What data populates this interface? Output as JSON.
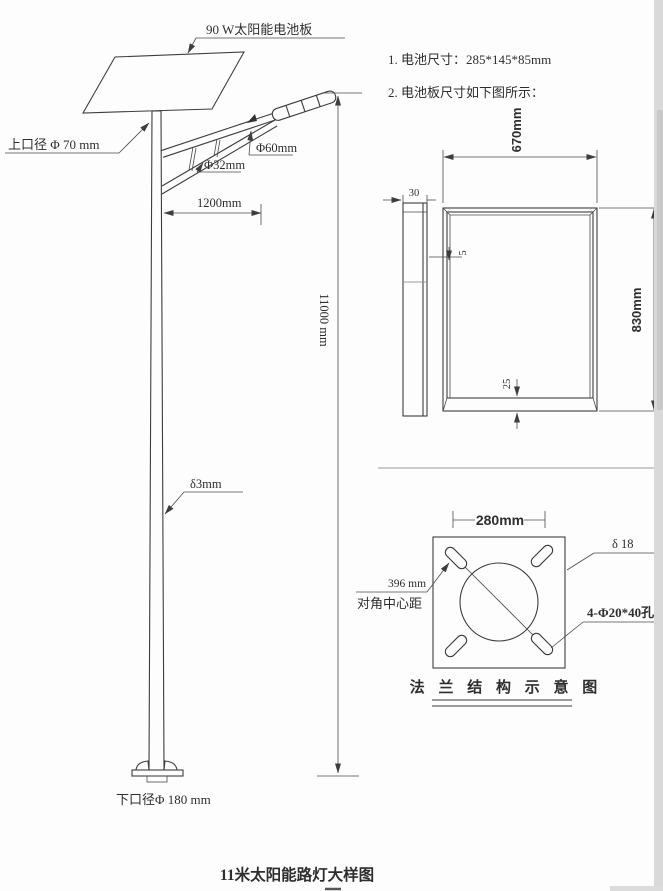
{
  "colors": {
    "background": "#fdfdfd",
    "line": "#3d3d3d",
    "text": "#2e2e2e",
    "scan_edge": "#d6d6d6"
  },
  "pole_view": {
    "panel_label": "90 W太阳能电池板",
    "top_diameter": "上口径 Φ 70 mm",
    "lamp_arm_diameter": "Φ60mm",
    "brace_diameter": "Φ32mm",
    "arm_length": "1200mm",
    "pole_height": "11000 mm",
    "wall_thickness": "δ3mm",
    "bottom_diameter": "下口径Φ 180 mm"
  },
  "notes": {
    "line1": "1. 电池尺寸：285*145*85mm",
    "line2": "2. 电池板尺寸如下图所示："
  },
  "panel_detail": {
    "width": "670mm",
    "height": "830mm",
    "thickness": "30",
    "frame_lip": "5",
    "bottom_lip": "25"
  },
  "flange_detail": {
    "bolt_spacing": "280mm",
    "plate_thickness": "δ 18",
    "diagonal_distance": "396 mm",
    "diagonal_note": "对角中心距",
    "holes": "4-Φ20*40孔",
    "caption": "法 兰 结 构 示 意 图"
  },
  "title": "11米太阳能路灯大样图"
}
